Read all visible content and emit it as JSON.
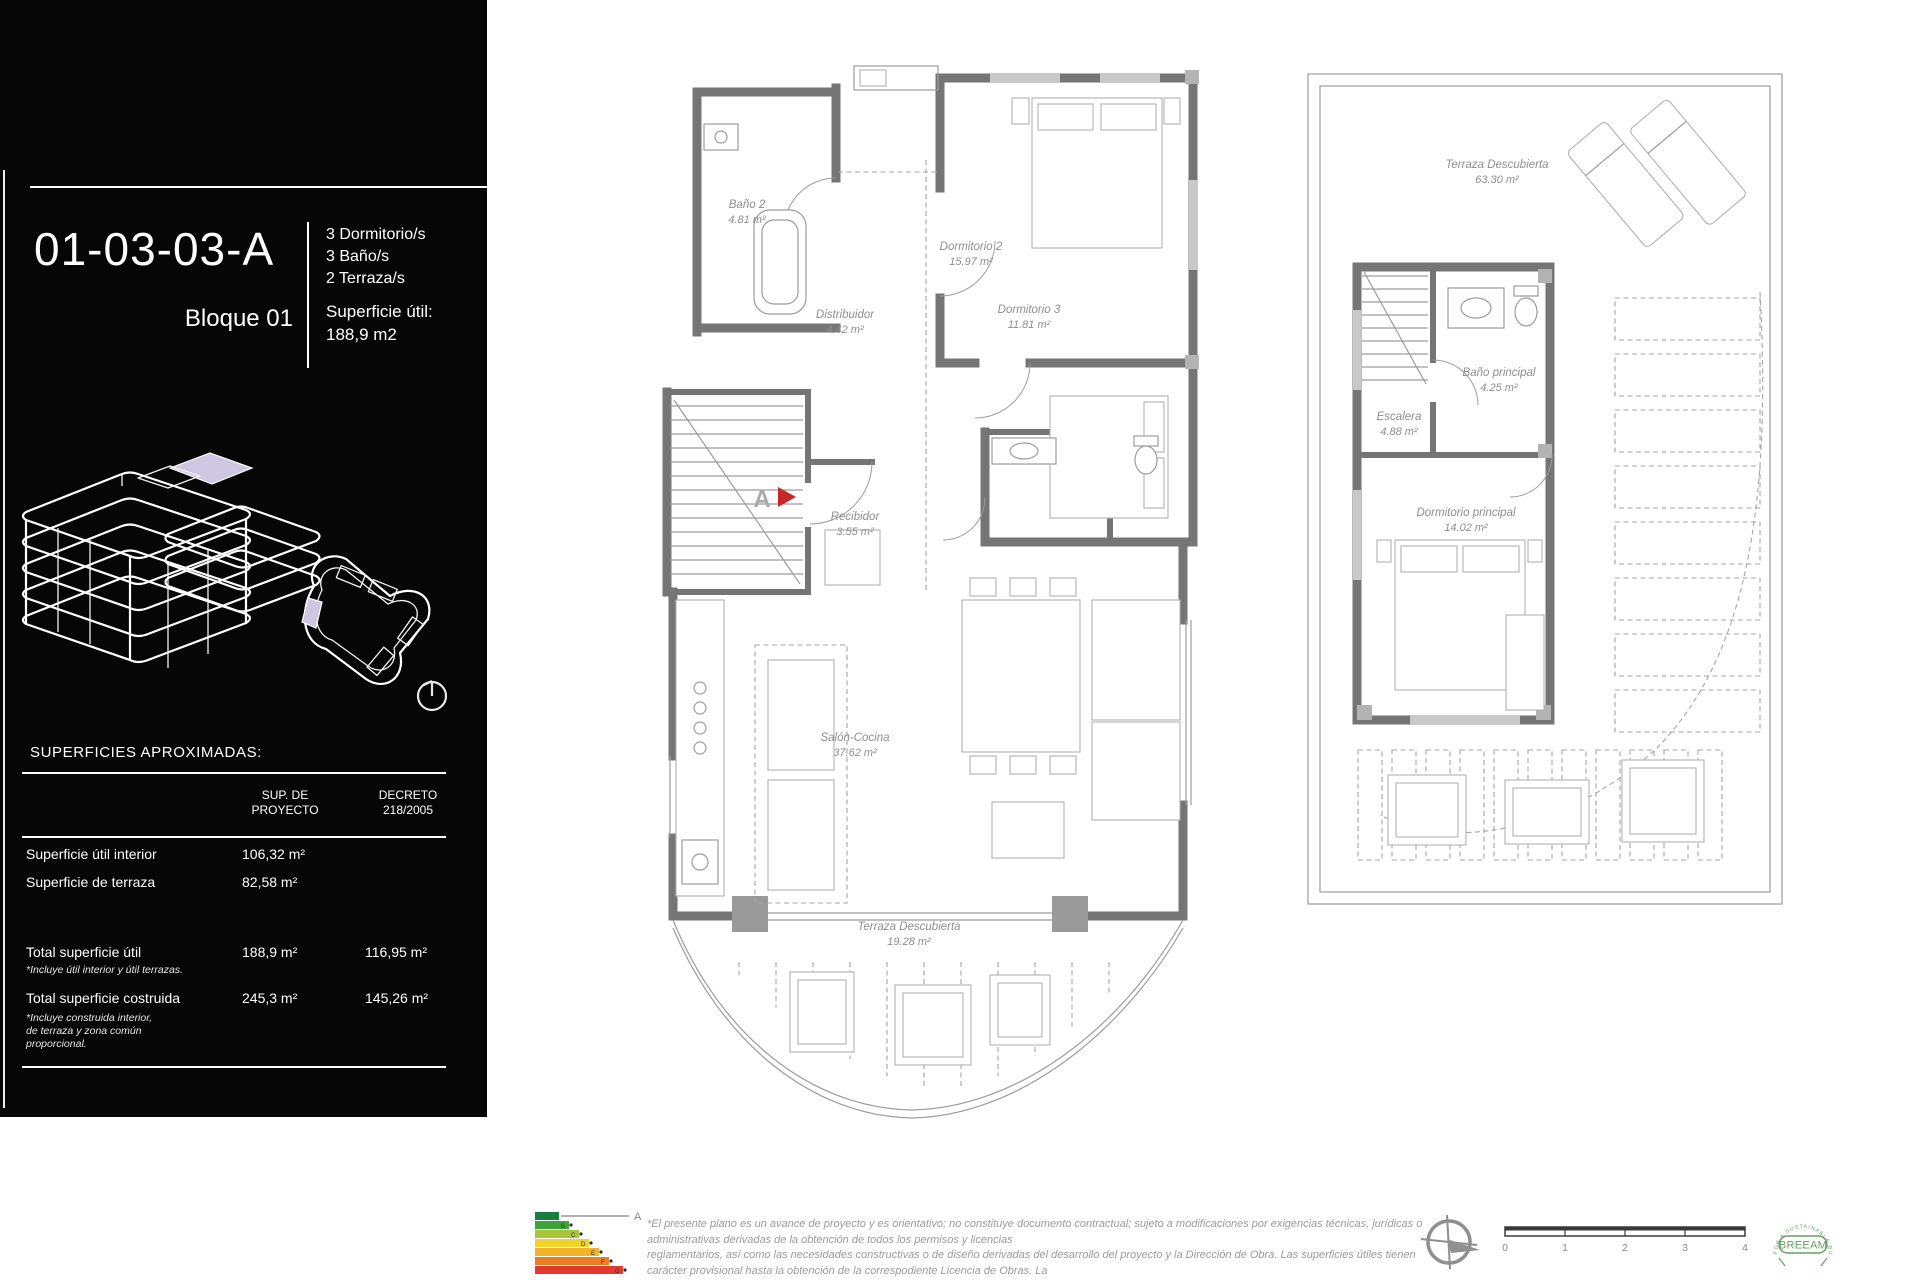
{
  "sidebar": {
    "unit_code": "01-03-03-A",
    "block": "Bloque 01",
    "features": [
      "3 Dormitorio/s",
      "3 Baño/s",
      "2 Terraza/s"
    ],
    "superficie_util_label": "Superficie útil:",
    "superficie_util_value": "188,9  m2",
    "surfaces_heading": "SUPERFICIES APROXIMADAS:",
    "table": {
      "headers": [
        {
          "line1": "SUP. DE",
          "line2": "PROYECTO"
        },
        {
          "line1": "DECRETO",
          "line2": "218/2005"
        }
      ],
      "rows": [
        {
          "label": "Superficie útil interior",
          "proyecto": "106,32  m²",
          "decreto": ""
        },
        {
          "label": "Superficie de terraza",
          "proyecto": "82,58  m²",
          "decreto": ""
        },
        {
          "label": "Total superficie útil",
          "proyecto": "188,9  m²",
          "decreto": "116,95  m²",
          "note": "*Incluye útil interior y útil terrazas."
        },
        {
          "label": "Total superficie costruida",
          "proyecto": "245,3  m²",
          "decreto": "145,26  m²",
          "note": "*Incluye construida interior,\nde terraza y zona común\nproporcional."
        }
      ]
    }
  },
  "plans": {
    "left": {
      "entry_marker": "A",
      "rooms": [
        {
          "name": "Baño 2",
          "area": "4.81 m²"
        },
        {
          "name": "Dormitorio 2",
          "area": "15.97 m²"
        },
        {
          "name": "Distribuidor",
          "area": "4.42 m²"
        },
        {
          "name": "Dormitorio 3",
          "area": "11.81 m²"
        },
        {
          "name": "Recibidor",
          "area": "3.55 m²"
        },
        {
          "name": "Salón-Cocina",
          "area": "37.62 m²"
        },
        {
          "name": "Terraza Descubierta",
          "area": "19.28 m²"
        }
      ]
    },
    "right": {
      "rooms": [
        {
          "name": "Terraza Descubierta",
          "area": "63.30 m²"
        },
        {
          "name": "Escalera",
          "area": "4.88 m²"
        },
        {
          "name": "Baño principal",
          "area": "4.25 m²"
        },
        {
          "name": "Dormitorio principal",
          "area": "14.02 m²"
        }
      ]
    }
  },
  "footer": {
    "disclaimer_lines": [
      "*El presente plano es un avance de proyecto y es orientativo; no constituye documento contractual; sujeto a modificaciones por exigencias técnicas, jurídicas o",
      "administrativas derivadas de la obtención de todos los permisos y licencias",
      "reglamentarios, así como las necesidades constructivas o de diseño derivadas del desarrollo del proyecto y la Dirección de Obra. Las superficies útiles tienen",
      "carácter provisional hasta la obtención de la correspodiente Licencia de Obras. La",
      "jardinería, el mobiliario urbano y el amueblamiento es ficticio; teniendo validez únicamente a efectos decorativos"
    ],
    "energy": {
      "rating": "A",
      "bar_letters": [
        "B",
        "C",
        "D",
        "E",
        "F",
        "G"
      ]
    },
    "scale_ticks": [
      "0",
      "1",
      "2",
      "3",
      "4"
    ],
    "breeam": {
      "center_text": "BREEAM",
      "ring_text": "FOR A SUSTAINABLE BUILT ENVIRONMENT"
    }
  },
  "icons": {
    "north_indicator": "circle-with-radius-line",
    "compass_rose": "crosshair-circle-with-arrow",
    "energy_label": "colored-rating-bars",
    "breeam_badge": "circular-green-seal"
  },
  "colors": {
    "sidebar_bg": "#060606",
    "highlight_lavender": "#cfc6e2",
    "wall_gray": "#757575",
    "plan_label_gray": "#8e8e8e",
    "entry_marker_red": "#c62828",
    "breeam_green": "#63a063",
    "energy_bar_colors": [
      "#157f3d",
      "#3fa33a",
      "#a8c43a",
      "#f0d22d",
      "#f2b32b",
      "#ec7d23",
      "#e23a2e"
    ]
  }
}
